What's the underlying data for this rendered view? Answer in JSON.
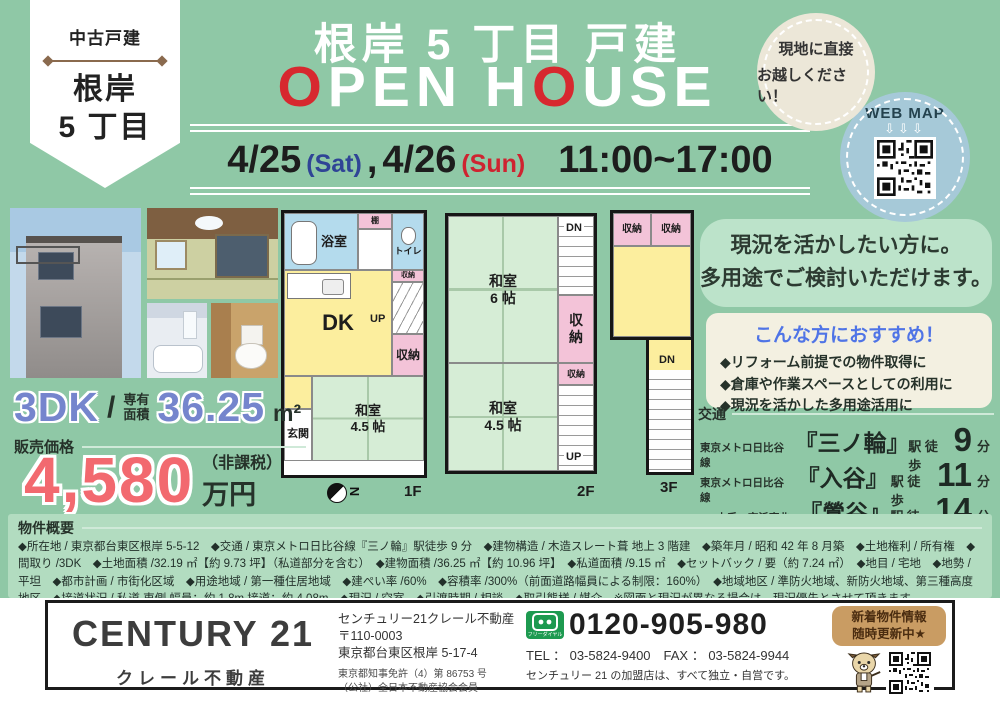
{
  "ribbon": {
    "category": "中古戸建",
    "area1": "根岸",
    "area2": "5 丁目"
  },
  "header": {
    "title": "根岸 5 丁目 戸建",
    "open_house": {
      "o1": "O",
      "p1": "PEN H",
      "o2": "O",
      "p2": "USE"
    },
    "date": {
      "d1": "4/25",
      "w1": "(Sat)",
      "comma": ",",
      "d2": "4/26",
      "w2": "(Sun)",
      "time": "11:00~17:00"
    },
    "visit": {
      "line1": "現地に直接",
      "line2": "お越しください！"
    },
    "webmap": {
      "label": "WEB MAP",
      "arrows": "⇩⇩⇩"
    }
  },
  "floorplans": {
    "f1": {
      "label": "1F",
      "bath": "浴室",
      "shelf": "棚",
      "toilet": "トイレ",
      "dk": "DK",
      "up": "UP",
      "closet_top": "収納",
      "closet": "収納",
      "room_name": "和室",
      "room_size": "4.5 帖",
      "entrance": "玄関",
      "compass_n": "N"
    },
    "f2": {
      "label": "2F",
      "room6_name": "和室",
      "room6_size": "6 帖",
      "dn": "DN",
      "closet_mid": "収納",
      "closet_small": "収納",
      "room45_name": "和室",
      "room45_size": "4.5 帖",
      "up": "UP"
    },
    "f3": {
      "label": "3F",
      "closet1": "収納",
      "closet2": "収納",
      "dn": "DN"
    }
  },
  "catch": {
    "line1": "現況を活かしたい方に。",
    "line2": "多用途でご検討いただけます。"
  },
  "recommend": {
    "title": "こんな方におすすめ！",
    "items": [
      "◆リフォーム前提での物件取得に",
      "◆倉庫や作業スペースとしての利用に",
      "◆現況を活かした多用途活用に"
    ]
  },
  "access": {
    "label": "交通",
    "routes": [
      {
        "line": "東京メトロ日比谷線",
        "station": "『三ノ輪』",
        "walk": "駅 徒歩",
        "minutes": "9",
        "unit": "分"
      },
      {
        "line": "東京メトロ日比谷線",
        "station": "『入谷』",
        "walk": "駅 徒歩",
        "minutes": "11",
        "unit": "分"
      },
      {
        "line": "JR 山手・京浜東北線",
        "station": "『鶯谷』",
        "walk": "駅 徒歩",
        "minutes": "14",
        "unit": "分"
      }
    ]
  },
  "unit": {
    "layout": "3DK",
    "slash": "/",
    "area_label1": "専有",
    "area_label2": "面積",
    "area_value": "36.25",
    "area_unit": "m²"
  },
  "price": {
    "label": "販売価格",
    "value": "4,580",
    "tax": "（非課税）",
    "unit": "万円"
  },
  "overview": {
    "label": "物件概要",
    "text": "◆所在地 / 東京都台東区根岸 5-5-12　◆交通 / 東京メトロ日比谷線『三ノ輪』駅徒歩 9 分　◆建物構造 / 木造スレート葺 地上 3 階建　◆築年月 / 昭和 42 年 8 月築　◆土地権利 / 所有権　◆間取り /3DK　◆土地面積 /32.19 ㎡【約 9.73 坪】（私道部分を含む）　◆建物面積 /36.25 ㎡【約 10.96 坪】　◆私道面積 /9.15 ㎡　◆セットバック / 要（約 7.24 ㎡）　◆地目 / 宅地　◆地勢 / 平坦　◆都市計画 / 市街化区域　◆用途地域 / 第一種住居地域　◆建ぺい率 /60%　◆容積率 /300%（前面道路幅員による制限：160%）　◆地域地区 / 準防火地域、新防火地域、第三種高度地区　◆接道状況 / 私道 東側 幅員：約 1.8m 接道：約 4.08m　◆現況 / 空室　◆引渡時期 / 相談　◆取引態様 / 媒介　※図面と現況が異なる場合は、現況優先とさせて頂きます。"
  },
  "footer": {
    "logo": "CENTURY 21",
    "logo_sub": "クレール不動産",
    "company": "センチュリー21クレール不動産",
    "postal": "〒110-0003",
    "address": "東京都台東区根岸 5-17-4",
    "license": "東京都知事免許（4）第 86753 号",
    "member": "（公社）全日本不動産協会会員",
    "freedial_label": "フリーダイヤル",
    "phone": "0120-905-980",
    "telfax": "TEL ： 03-5824-9400　FAX ： 03-5824-9944",
    "note": "センチュリー 21 の加盟店は、すべて独立・自営です。",
    "badge_line1": "新着物件情報",
    "badge_line2": "随時更新中★"
  }
}
